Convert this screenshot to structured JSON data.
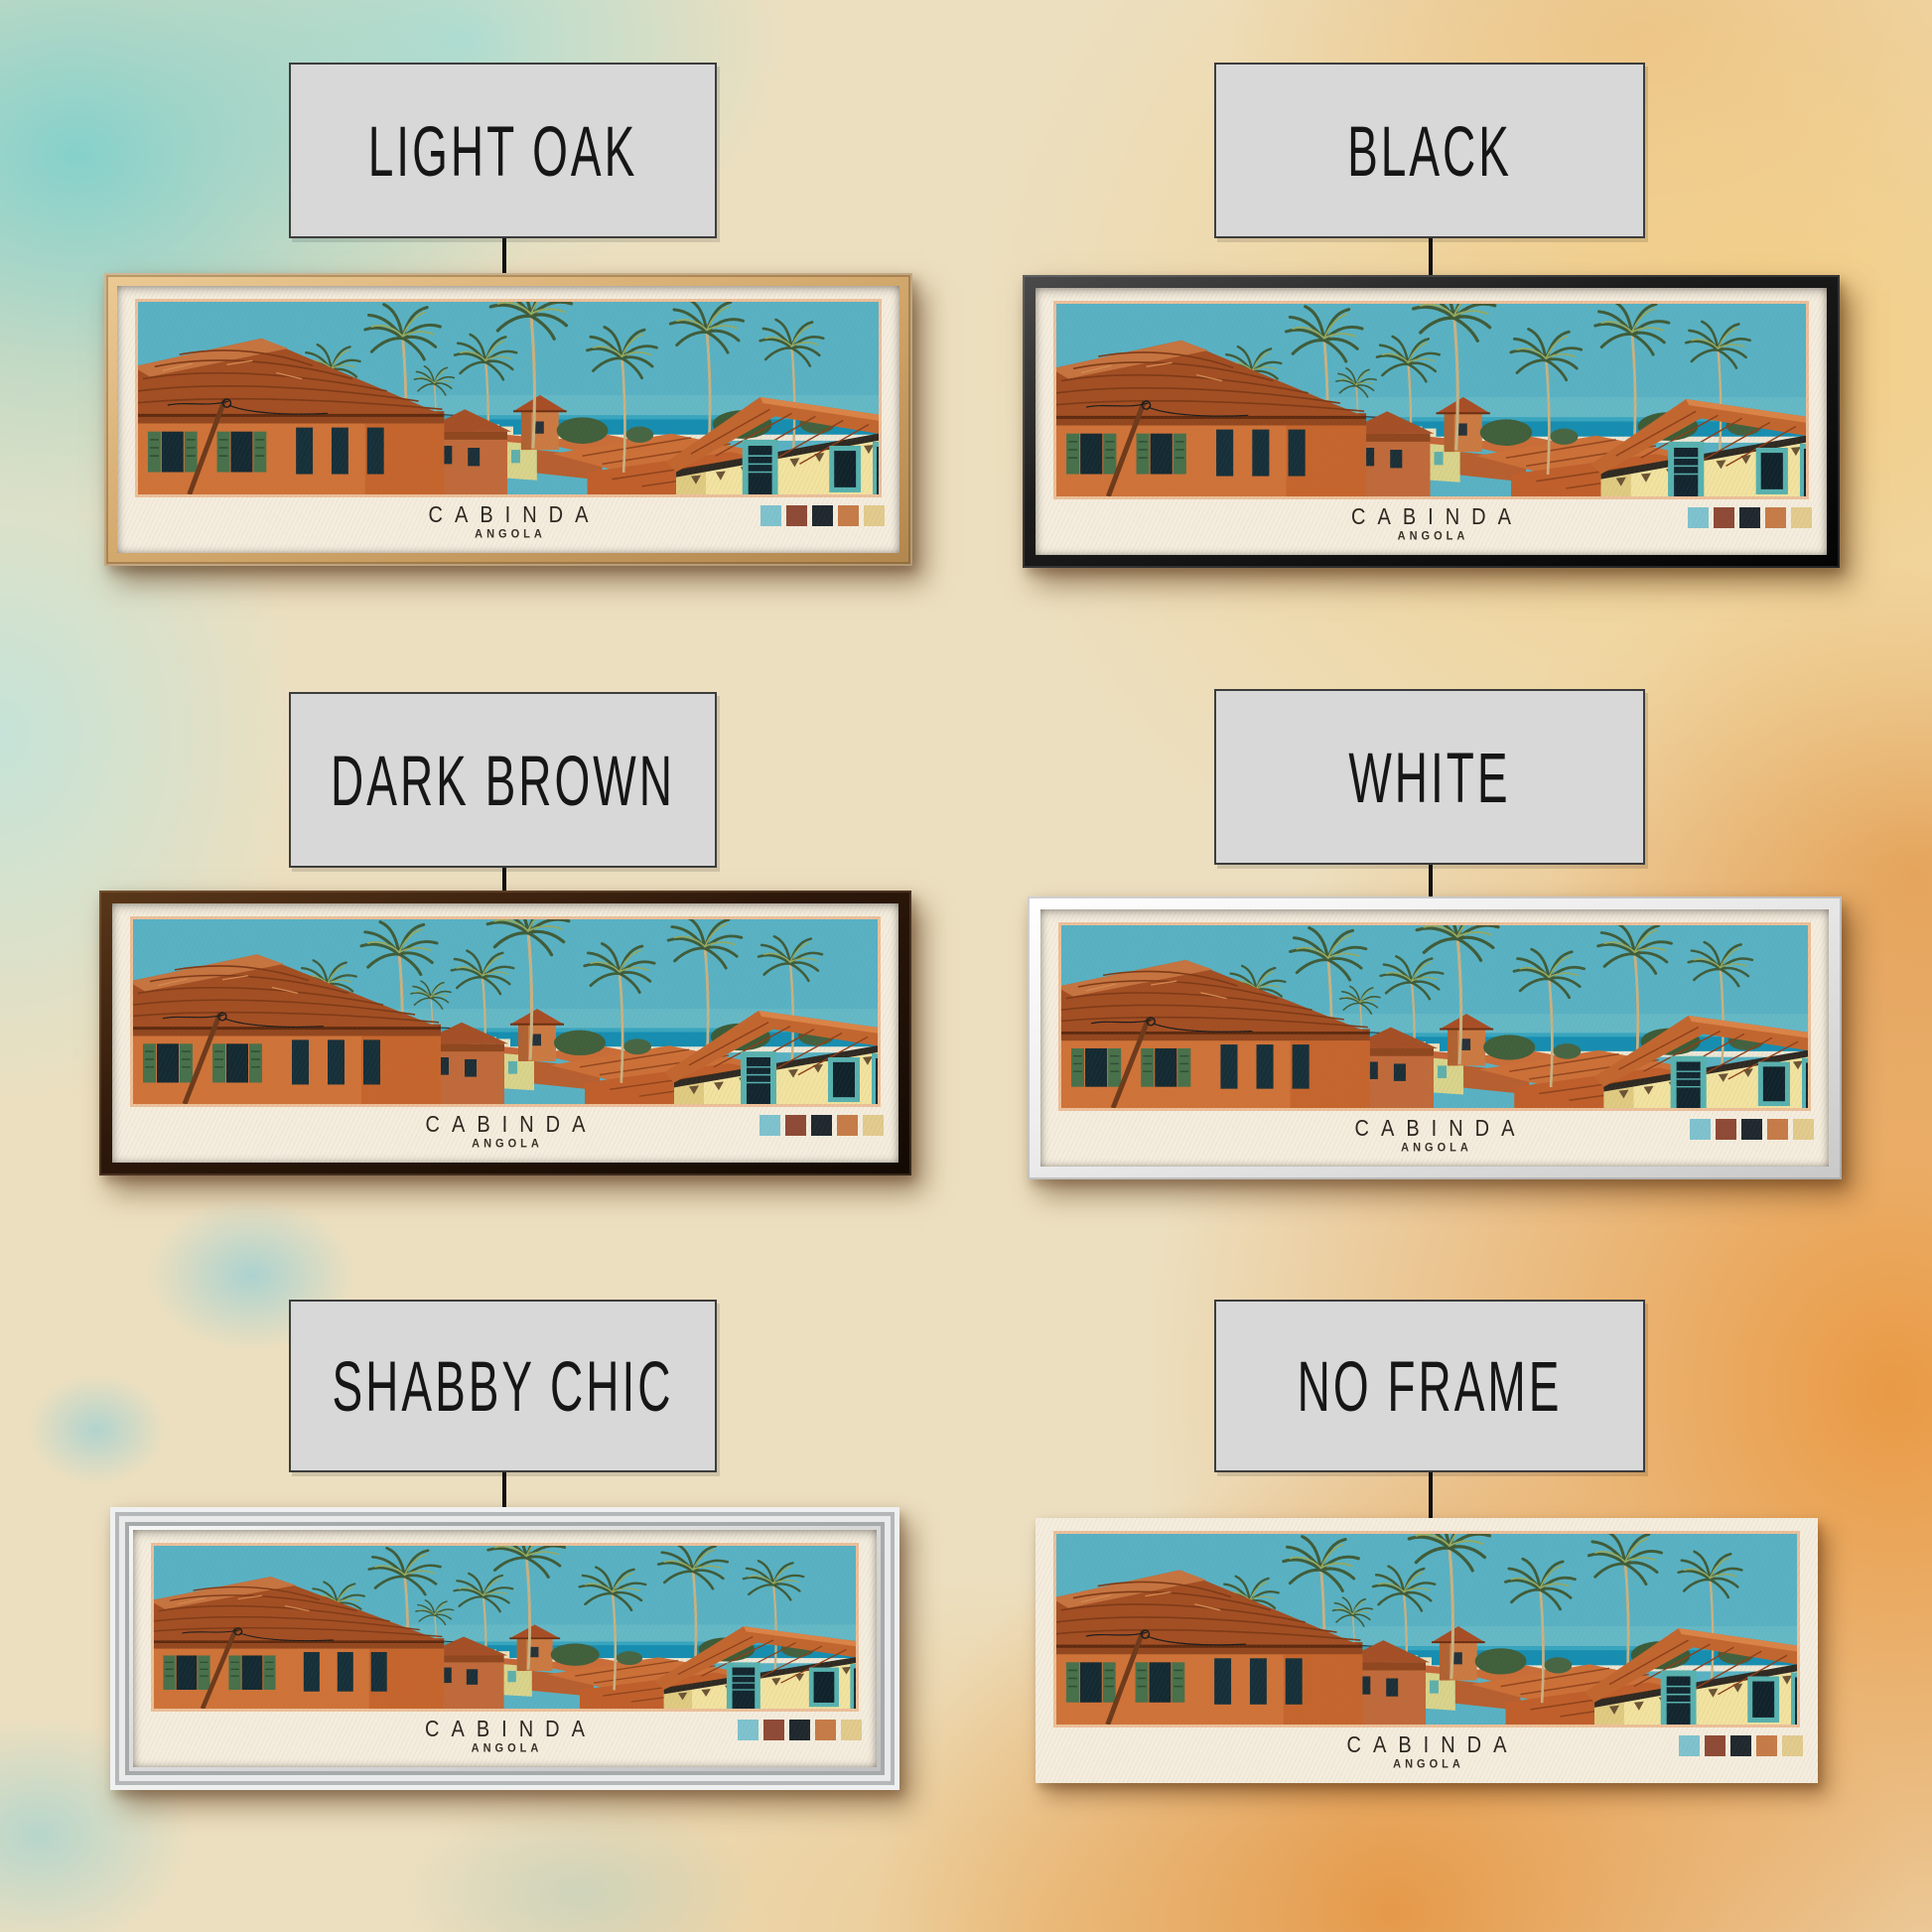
{
  "print": {
    "title": "CABINDA",
    "subtitle": "ANGOLA",
    "palette": [
      "#7ec3cf",
      "#8e4a36",
      "#1f282e",
      "#c67c48",
      "#e2cb8d"
    ]
  },
  "variants": [
    {
      "id": "light-oak",
      "label": "LIGHT OAK",
      "frame_color": "#d5ab70"
    },
    {
      "id": "black",
      "label": "BLACK",
      "frame_color": "#141414"
    },
    {
      "id": "dark-brown",
      "label": "DARK BROWN",
      "frame_color": "#2c170a"
    },
    {
      "id": "white",
      "label": "WHITE",
      "frame_color": "#ebebeb"
    },
    {
      "id": "shabby-chic",
      "label": "SHABBY CHIC",
      "frame_color": "#dedede"
    },
    {
      "id": "no-frame",
      "label": "NO FRAME",
      "frame_color": "none"
    }
  ]
}
